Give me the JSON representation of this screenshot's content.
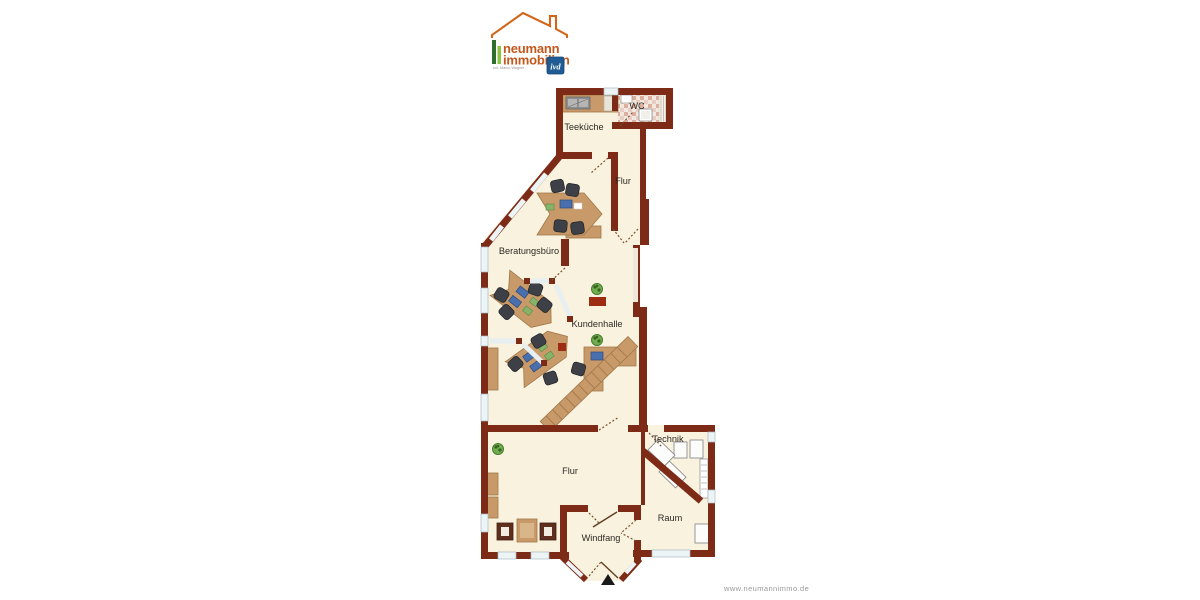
{
  "page": {
    "background": "#ffffff"
  },
  "logo": {
    "line1": "neumann",
    "line2": "immobilien",
    "subtitle": "Inh. Marco Wagner",
    "badge": "ivd",
    "colors": {
      "text_orange": "#c4571b",
      "roof_orange": "#d2671c",
      "bar_dark_green": "#2f6e2d",
      "bar_light_green": "#8bc53f",
      "badge_blue": "#1f5c95"
    }
  },
  "floorplan": {
    "rooms": [
      {
        "id": "teekueche",
        "label": "Teeküche"
      },
      {
        "id": "wc",
        "label": "WC"
      },
      {
        "id": "flur_top",
        "label": "Flur"
      },
      {
        "id": "beratungsbuero",
        "label": "Beratungsbüro"
      },
      {
        "id": "kundenhalle",
        "label": "Kundenhalle"
      },
      {
        "id": "technik",
        "label": "Technik"
      },
      {
        "id": "flur_bottom",
        "label": "Flur"
      },
      {
        "id": "raum",
        "label": "Raum"
      },
      {
        "id": "windfang",
        "label": "Windfang"
      }
    ],
    "colors": {
      "wall": "#7d2a16",
      "floor": "#f9f2de",
      "window": "#edf4f6",
      "wood": "#c99a69",
      "chair": "#3d4046",
      "plant": "#6fae4e",
      "accent_red": "#9e2c12"
    },
    "icons": [
      "window",
      "door-swing",
      "glass-partition",
      "desk",
      "office-chair",
      "monitor",
      "plant",
      "staircase",
      "kitchen-counter",
      "sink",
      "toilet",
      "wc-tiles",
      "ventilation-shaft",
      "sideboard",
      "cabinet",
      "waiting-chair",
      "side-table",
      "technical-equipment",
      "radiator",
      "entrance-arrow"
    ]
  },
  "footer": {
    "url": "www.neumannimmo.de"
  }
}
